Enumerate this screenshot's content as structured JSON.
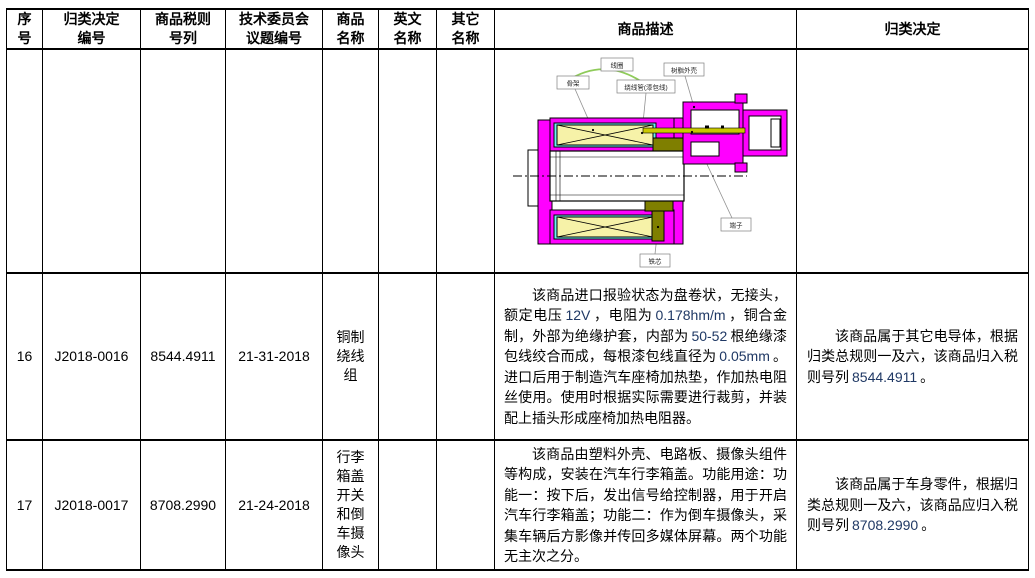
{
  "header": {
    "cols": [
      "序号",
      "归类决定编号",
      "商品税则号列",
      "技术委员会议题编号",
      "商品名称",
      "英文名称",
      "其它名称",
      "商品描述",
      "归类决定"
    ]
  },
  "diagram": {
    "labels": {
      "coil": "线圈",
      "bobbin": "骨架",
      "winding_wire": "绕线管(漆包线)",
      "resin_shell": "树脂外壳",
      "terminal": "端子",
      "core": "铁芯"
    },
    "colors": {
      "housing": "#FF00FF",
      "coil": "#F6F2A8",
      "bobbin": "#6BF1F1",
      "core": "#7F7F00",
      "pin": "#C9C900",
      "arc": "#8FCB5A"
    }
  },
  "rows": [
    {
      "no": "",
      "decision_no": "",
      "tariff_no": "",
      "committee_no": "",
      "name": "",
      "english_name": "",
      "other_name": "",
      "decision": ""
    },
    {
      "no": "16",
      "decision_no": "J2018-0016",
      "tariff_no": "8544.4911",
      "committee_no": "21-31-2018",
      "name": "铜制绕线组",
      "english_name": "",
      "other_name": "",
      "description_segments": [
        {
          "t": "该商品进口报验状态为盘卷状，无接头，额定电压"
        },
        {
          "t": "12V",
          "num": true
        },
        {
          "t": "，电阻为"
        },
        {
          "t": "0.178hm/m",
          "num": true
        },
        {
          "t": "，铜合金制，外部为绝缘护套，内部为"
        },
        {
          "t": "50-52",
          "num": true
        },
        {
          "t": "根绝缘漆包线绞合而成，每根漆包线直径为"
        },
        {
          "t": "0.05mm",
          "num": true
        },
        {
          "t": "。进口后用于制造汽车座椅加热垫，作加热电阻丝使用。使用时根据实际需要进行裁剪，并装配上插头形成座椅加热电阻器。"
        }
      ],
      "decision_segments": [
        {
          "t": "该商品属于其它电导体，根据归类总规则一及六，该商品归入税则号列"
        },
        {
          "t": "8544.4911",
          "num": true
        },
        {
          "t": "。"
        }
      ]
    },
    {
      "no": "17",
      "decision_no": "J2018-0017",
      "tariff_no": "8708.2990",
      "committee_no": "21-24-2018",
      "name": "行李箱盖开关和倒车摄像头",
      "english_name": "",
      "other_name": "",
      "description_segments": [
        {
          "t": "该商品由塑料外壳、电路板、摄像头组件等构成，安装在汽车行李箱盖。功能用途：功能一：按下后，发出信号给控制器，用于开启汽车行李箱盖；功能二：作为倒车摄像头，采集车辆后方影像并传回多媒体屏幕。两个功能无主次之分。"
        }
      ],
      "decision_segments": [
        {
          "t": "该商品属于车身零件，根据归类总规则一及六，该商品应归入税则号列"
        },
        {
          "t": "8708.2990",
          "num": true
        },
        {
          "t": "。"
        }
      ]
    }
  ]
}
